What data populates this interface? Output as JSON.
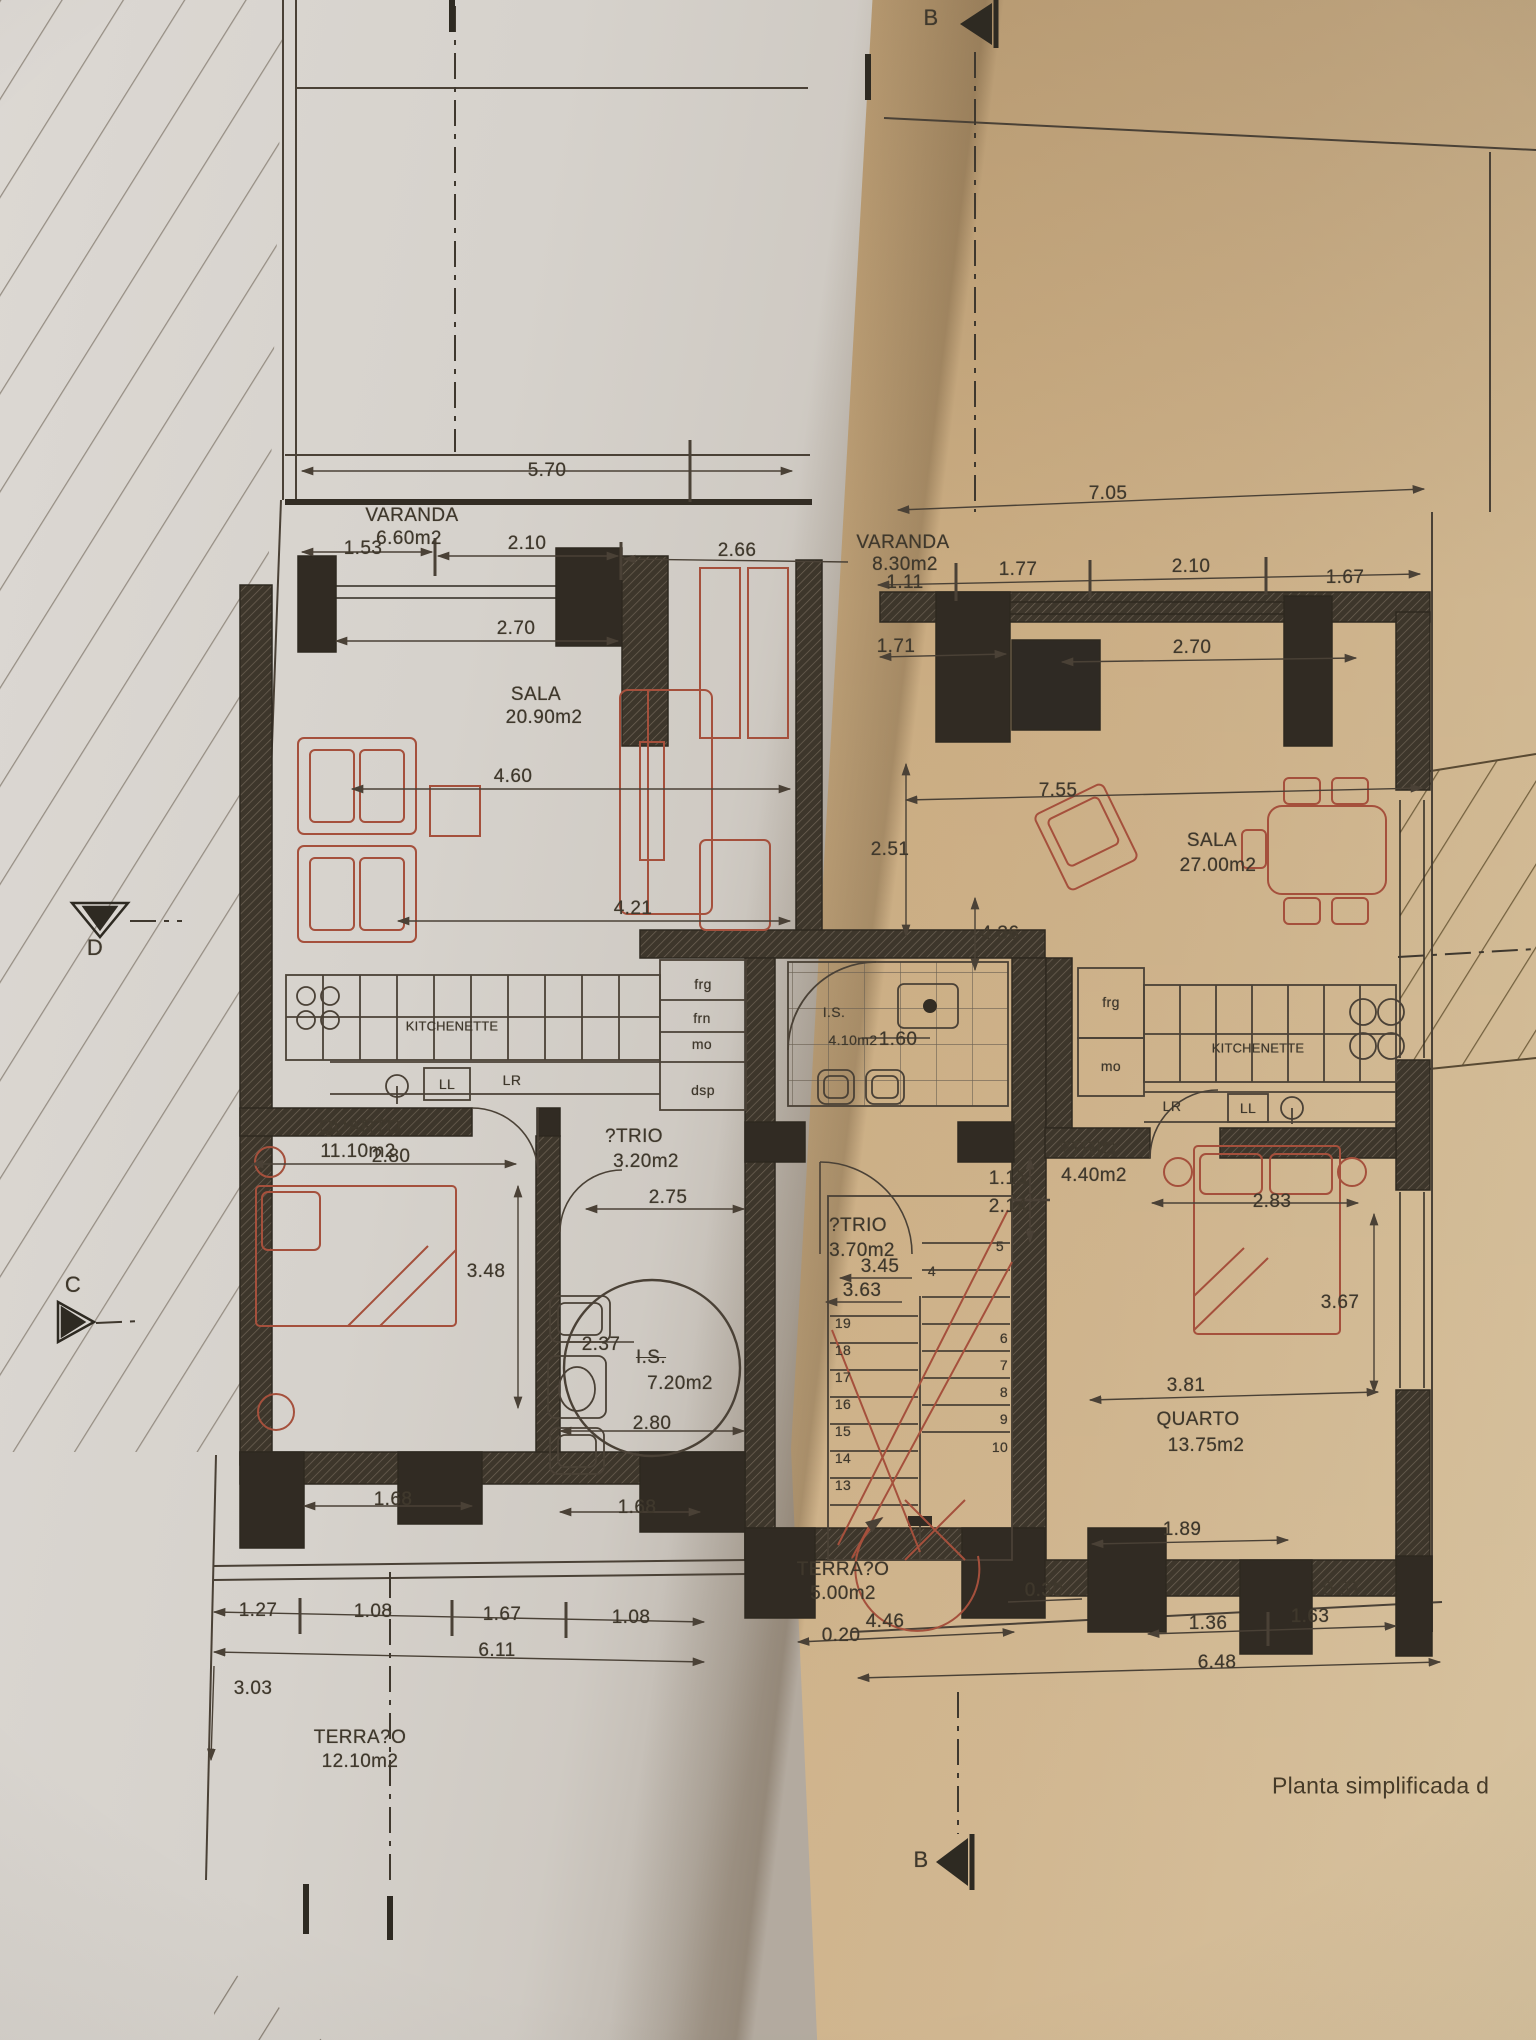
{
  "caption": "Planta simplificada d",
  "markers": {
    "b_top": "B",
    "b_bottom": "B",
    "d": "D",
    "c": "C"
  },
  "units": {
    "left": {
      "varanda": {
        "name": "VARANDA",
        "area": "6.60m2"
      },
      "sala": {
        "name": "SALA",
        "area": "20.90m2"
      },
      "kitchenette": {
        "name": "KITCHENETTE",
        "appliances": {
          "frg": "frg",
          "frn": "frn",
          "mo": "mo",
          "dsp": "dsp",
          "ll": "LL",
          "lr": "LR"
        }
      },
      "quarto": {
        "name": "QUARTO",
        "area": "11.10m2"
      },
      "atrio": {
        "name": "?TRIO",
        "area": "3.20m2"
      },
      "is": {
        "name": "I.S.",
        "area": "7.20m2"
      },
      "terraco": {
        "name": "TERRA?O",
        "area": "12.10m2"
      }
    },
    "core": {
      "is": {
        "name": "I.S.",
        "area": "4.10m2"
      },
      "atrio": {
        "name": "?TRIO",
        "area": "3.70m2"
      },
      "terraco": {
        "name": "TERRA?O",
        "area": "5.00m2"
      }
    },
    "right": {
      "varanda": {
        "name": "VARANDA",
        "area": "8.30m2"
      },
      "sala": {
        "name": "SALA",
        "area": "27.00m2"
      },
      "kitchenette": {
        "name": "KITCHENETTE",
        "appliances": {
          "frg": "frg",
          "mo": "mo",
          "lr": "LR",
          "ll": "LL"
        }
      },
      "atrio": {
        "name": "?TRIO",
        "area": "4.40m2"
      },
      "quarto": {
        "name": "QUARTO",
        "area": "13.75m2"
      }
    }
  },
  "dims": {
    "t570": "5.70",
    "t153": "1.53",
    "t210a": "2.10",
    "t266": "2.66",
    "t270a": "2.70",
    "t460": "4.60",
    "t421": "4.21",
    "t280a": "2.80",
    "t275": "2.75",
    "t348": "3.48",
    "t237": "2.37",
    "t280b": "2.80",
    "t168a": "1.68",
    "t168b": "1.68",
    "t127": "1.27",
    "t108a": "1.08",
    "t167a": "1.67",
    "t108b": "1.08",
    "t611": "6.11",
    "t303": "3.03",
    "t160": "1.60",
    "t345": "3.45",
    "t363": "3.63",
    "t020": "0.20",
    "t446": "4.46",
    "t030": "0.30",
    "t705": "7.05",
    "t111": "1.11",
    "t177": "1.77",
    "t210b": "2.10",
    "t167b": "1.67",
    "t171": "1.71",
    "t270b": "2.70",
    "t251": "2.51",
    "t755": "7.55",
    "t436": "4.36",
    "t115": "1.15",
    "t214": "2.14",
    "t283": "2.83",
    "t367": "3.67",
    "t381": "3.81",
    "t189": "1.89",
    "t136": "1.36",
    "t163": "1.63",
    "t648": "6.48",
    "t037": "0.37"
  },
  "stairs": {
    "left": [
      "19",
      "18",
      "17",
      "16",
      "15",
      "14",
      "13"
    ],
    "right": [
      "4",
      "5",
      "6",
      "7",
      "8",
      "9",
      "10"
    ]
  }
}
